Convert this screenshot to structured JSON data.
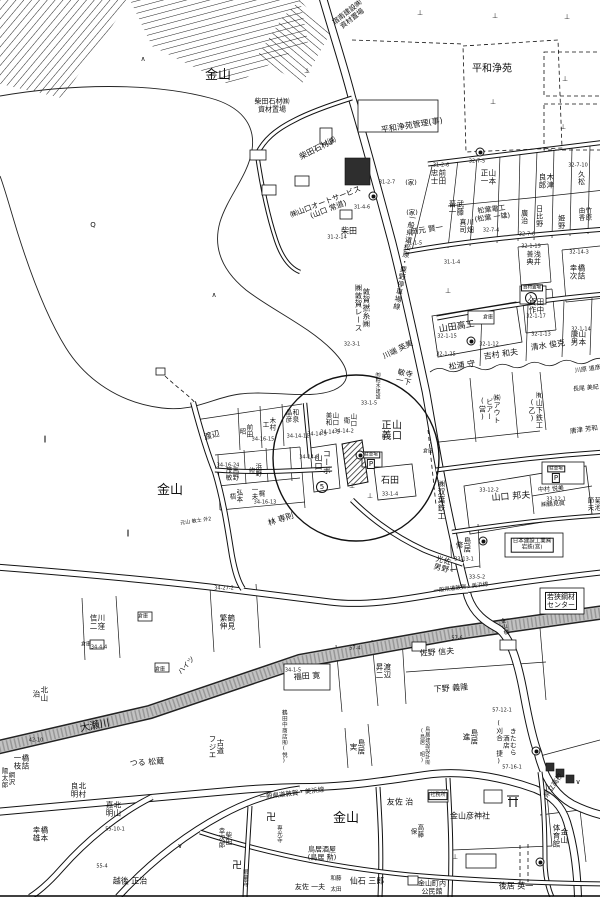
{
  "map": {
    "region_labels": [
      {
        "t": "宿南建設㈱\n資材置場",
        "x": 350,
        "y": 16,
        "s": 7,
        "r": -38
      },
      {
        "t": "金山",
        "x": 218,
        "y": 76,
        "s": 13
      },
      {
        "t": "平和浄苑",
        "x": 492,
        "y": 70,
        "s": 10
      },
      {
        "t": "平和浄苑管理(事)",
        "x": 412,
        "y": 126,
        "s": 8,
        "r": -9
      },
      {
        "t": "柴田石材㈱\n資材置場",
        "x": 272,
        "y": 106,
        "s": 7
      },
      {
        "t": "柴田石材㈱",
        "x": 318,
        "y": 149,
        "s": 8,
        "r": -27
      },
      {
        "t": "㈱山口オートサービス\n(山口 常道)",
        "x": 327,
        "y": 206,
        "s": 7.5,
        "r": -21
      },
      {
        "t": "柴田",
        "x": 349,
        "y": 232,
        "s": 8
      },
      {
        "t": "一般県道松原・粟野停車場線",
        "x": 404,
        "y": 262,
        "s": 7,
        "v": 1,
        "r": 10
      },
      {
        "t": "前田\n忠士",
        "x": 438,
        "y": 177,
        "s": 7.5,
        "v": 1
      },
      {
        "t": "山本\n正一",
        "x": 488,
        "y": 177,
        "s": 7.5,
        "v": 1
      },
      {
        "t": "(家)",
        "x": 411,
        "y": 183,
        "s": 6.5
      },
      {
        "t": "(家)",
        "x": 412,
        "y": 213,
        "s": 6.5
      },
      {
        "t": "武藤\n晋一",
        "x": 456,
        "y": 208,
        "s": 7.5,
        "v": 1
      },
      {
        "t": "岡元 賢一",
        "x": 427,
        "y": 230,
        "s": 7.5,
        "r": -9
      },
      {
        "t": "川畑\n真司",
        "x": 466,
        "y": 226,
        "s": 7,
        "v": 1
      },
      {
        "t": "木津\n良郎",
        "x": 546,
        "y": 181,
        "s": 7.5,
        "v": 1
      },
      {
        "t": "久松",
        "x": 581,
        "y": 178,
        "s": 7,
        "v": 1
      },
      {
        "t": "松葉電工\n(松葉 一雄)",
        "x": 492,
        "y": 214,
        "s": 7,
        "r": -7
      },
      {
        "t": "廣治",
        "x": 524,
        "y": 217,
        "s": 7,
        "v": 1
      },
      {
        "t": "日比野",
        "x": 539,
        "y": 216,
        "s": 7,
        "v": 1
      },
      {
        "t": "姫野",
        "x": 561,
        "y": 222,
        "s": 7,
        "v": 1
      },
      {
        "t": "竹原\n由香",
        "x": 584,
        "y": 214,
        "s": 6.5,
        "v": 1
      },
      {
        "t": "浅井\n善典",
        "x": 533,
        "y": 258,
        "s": 7,
        "v": 1
      },
      {
        "t": "田中\n貞作",
        "x": 536,
        "y": 306,
        "s": 7.5,
        "v": 1
      },
      {
        "t": "橋詰\n幸次",
        "x": 577,
        "y": 272,
        "s": 7.5,
        "v": 1
      },
      {
        "t": "山田高工",
        "x": 457,
        "y": 328,
        "s": 9,
        "r": -9
      },
      {
        "t": "倉庫",
        "x": 488,
        "y": 318,
        "s": 5
      },
      {
        "t": "吉村 和夫",
        "x": 501,
        "y": 355,
        "s": 8,
        "r": -8
      },
      {
        "t": "清水 俊克",
        "x": 548,
        "y": 346,
        "s": 8,
        "r": -8
      },
      {
        "t": "山本\n康男",
        "x": 578,
        "y": 338,
        "s": 7.5,
        "v": 1
      },
      {
        "t": "松浦 守",
        "x": 462,
        "y": 366,
        "s": 8,
        "r": -8
      },
      {
        "t": "川原 道彦",
        "x": 588,
        "y": 370,
        "s": 6,
        "r": -8
      },
      {
        "t": "長尾 美紀",
        "x": 586,
        "y": 389,
        "s": 6,
        "r": -5
      },
      {
        "t": "唐津 芳和",
        "x": 584,
        "y": 430,
        "s": 6.5,
        "r": -7
      },
      {
        "t": "㈱アウト\nビアー\n(営)",
        "x": 489,
        "y": 409,
        "s": 7,
        "v": 1
      },
      {
        "t": "㈲山下鉄工\n(乙)",
        "x": 535,
        "y": 410,
        "s": 7,
        "v": 1
      },
      {
        "t": "山口 邦夫",
        "x": 511,
        "y": 498,
        "s": 9,
        "r": -4
      },
      {
        "t": "中村 悦美",
        "x": 551,
        "y": 490,
        "s": 6,
        "r": -4
      },
      {
        "t": "㈱鶴見眞",
        "x": 553,
        "y": 505,
        "s": 6,
        "r": -4
      },
      {
        "t": "菊池\n節夫",
        "x": 593,
        "y": 504,
        "s": 6.5,
        "v": 1
      },
      {
        "t": "島居\n修",
        "x": 463,
        "y": 545,
        "s": 7.5,
        "v": 1
      },
      {
        "t": "佐野\n光男",
        "x": 442,
        "y": 564,
        "s": 7.5,
        "v": 1,
        "r": 15
      },
      {
        "t": "日本建設工業㈱\n岩鉄(営)",
        "x": 532,
        "y": 545,
        "s": 5.5,
        "box": 1
      },
      {
        "t": "若狭鋼材\nセンター",
        "x": 561,
        "y": 601,
        "s": 7,
        "box": 1
      },
      {
        "t": "一般県道敦賀・美浜線",
        "x": 461,
        "y": 589,
        "s": 5.5,
        "r": -7
      },
      {
        "t": "金山",
        "x": 170,
        "y": 491,
        "s": 13
      },
      {
        "t": "渡辺",
        "x": 212,
        "y": 436,
        "s": 8,
        "r": -14
      },
      {
        "t": "前田\n昭",
        "x": 245,
        "y": 431,
        "s": 6.5,
        "v": 1
      },
      {
        "t": "木村\n工",
        "x": 268,
        "y": 424,
        "s": 6.5,
        "v": 1
      },
      {
        "t": "和泉\n晶彦",
        "x": 291,
        "y": 416,
        "s": 6.5,
        "v": 1
      },
      {
        "t": "山口\n美和",
        "x": 331,
        "y": 419,
        "s": 6.5,
        "v": 1
      },
      {
        "t": "山口\n衛",
        "x": 349,
        "y": 420,
        "s": 6.5,
        "v": 1
      },
      {
        "t": "山口\n正義",
        "x": 389,
        "y": 430,
        "s": 10,
        "v": 1
      },
      {
        "t": "コーポ\n山口",
        "x": 322,
        "y": 462,
        "s": 8,
        "v": 1
      },
      {
        "t": "石田",
        "x": 390,
        "y": 482,
        "s": 9
      },
      {
        "t": "㈱双葉鉄工",
        "x": 441,
        "y": 500,
        "s": 7.5,
        "v": 1
      },
      {
        "t": "倉庫",
        "x": 428,
        "y": 452,
        "s": 5
      },
      {
        "t": "馬野\n茂敏",
        "x": 231,
        "y": 474,
        "s": 6.5,
        "v": 1
      },
      {
        "t": "浜野\n修",
        "x": 254,
        "y": 470,
        "s": 6.5,
        "v": 1
      },
      {
        "t": "梶\n一夫",
        "x": 257,
        "y": 493,
        "s": 6.5,
        "v": 1
      },
      {
        "t": "弘本\n梧",
        "x": 235,
        "y": 496,
        "s": 6.5,
        "v": 1
      },
      {
        "t": "林 専則",
        "x": 281,
        "y": 520,
        "s": 8,
        "r": -18
      },
      {
        "t": "元山 敏士 外2",
        "x": 196,
        "y": 522,
        "s": 5,
        "r": -8
      },
      {
        "t": "寺下\n敏一",
        "x": 404,
        "y": 377,
        "s": 7.5,
        "v": 1,
        "r": 12
      },
      {
        "t": "川端 英美",
        "x": 398,
        "y": 350,
        "s": 7.5,
        "r": -26
      },
      {
        "t": "敦賀撚糸㈱\n㈱敦賀レース",
        "x": 362,
        "y": 308,
        "s": 7.5,
        "v": 1
      },
      {
        "t": "㈲柏木建設",
        "x": 377,
        "y": 386,
        "s": 5,
        "v": 1
      },
      {
        "t": "川窪\n信二",
        "x": 97,
        "y": 622,
        "s": 7.5,
        "v": 1
      },
      {
        "t": "鶴見\n繁伸",
        "x": 227,
        "y": 622,
        "s": 7.5,
        "v": 1
      },
      {
        "t": "北山\n治",
        "x": 40,
        "y": 694,
        "s": 7.5,
        "v": 1
      },
      {
        "t": "大瀬川",
        "x": 95,
        "y": 727,
        "s": 10,
        "r": -11
      },
      {
        "t": "ハイツ",
        "x": 187,
        "y": 666,
        "s": 7,
        "r": -48
      },
      {
        "t": "倉庫",
        "x": 86,
        "y": 645,
        "s": 5
      },
      {
        "t": "倉庫",
        "x": 143,
        "y": 617,
        "s": 5
      },
      {
        "t": "倉庫",
        "x": 160,
        "y": 670,
        "s": 5
      },
      {
        "t": "福田 寛",
        "x": 307,
        "y": 677,
        "s": 8,
        "r": -4
      },
      {
        "t": "渡辺\n昇二",
        "x": 383,
        "y": 671,
        "s": 7.5,
        "v": 1
      },
      {
        "t": "佐野 信夫",
        "x": 437,
        "y": 653,
        "s": 8,
        "r": -4
      },
      {
        "t": "下野 義隆",
        "x": 451,
        "y": 689,
        "s": 8,
        "r": -4
      },
      {
        "t": "島居\n実",
        "x": 357,
        "y": 747,
        "s": 7.5,
        "v": 1
      },
      {
        "t": "島居\n進",
        "x": 470,
        "y": 737,
        "s": 7.5,
        "v": 1
      },
      {
        "t": "きたむら\n酒店\n(刈合 捷)",
        "x": 505,
        "y": 742,
        "s": 6.5,
        "v": 1
      },
      {
        "t": "鳥居建設設計㈲\n(鳥居 昭)",
        "x": 424,
        "y": 746,
        "s": 5,
        "v": 1
      },
      {
        "t": "鶴田中商店㈲(悦)",
        "x": 283,
        "y": 737,
        "s": 5.5,
        "v": 1
      },
      {
        "t": "金山橋",
        "x": 503,
        "y": 627,
        "s": 5.5,
        "v": 1,
        "r": -15
      },
      {
        "t": "県立高校",
        "x": 554,
        "y": 786,
        "s": 7,
        "r": -55
      },
      {
        "t": "橋詰\n一枝",
        "x": 21,
        "y": 762,
        "s": 7.5,
        "v": 1
      },
      {
        "t": "網沢\n陽太郎",
        "x": 7,
        "y": 778,
        "s": 6.5,
        "v": 1
      },
      {
        "t": "北村\n良明",
        "x": 78,
        "y": 790,
        "s": 7.5,
        "v": 1
      },
      {
        "t": "北山\n嘉明",
        "x": 113,
        "y": 809,
        "s": 7.5,
        "v": 1
      },
      {
        "t": "橋本\n幸雄",
        "x": 40,
        "y": 834,
        "s": 7.5,
        "v": 1
      },
      {
        "t": "つる 松蔵",
        "x": 147,
        "y": 763,
        "s": 8,
        "r": -4
      },
      {
        "t": "古道\nフジエ",
        "x": 216,
        "y": 747,
        "s": 7.5,
        "v": 1
      },
      {
        "t": "一般県道敦賀・美浜線",
        "x": 292,
        "y": 794,
        "s": 6.5,
        "r": -7
      },
      {
        "t": "越後 正治",
        "x": 130,
        "y": 882,
        "s": 8
      },
      {
        "t": "柴田\n幸次郎",
        "x": 224,
        "y": 838,
        "s": 6.5,
        "v": 1
      },
      {
        "t": "専光寺",
        "x": 278,
        "y": 834,
        "s": 5.5,
        "v": 1
      },
      {
        "t": "眼量寺",
        "x": 244,
        "y": 878,
        "s": 5.5,
        "v": 1
      },
      {
        "t": "金山",
        "x": 346,
        "y": 819,
        "s": 13
      },
      {
        "t": "友佐 治",
        "x": 400,
        "y": 803,
        "s": 8
      },
      {
        "t": "高藤\n保",
        "x": 416,
        "y": 831,
        "s": 6.5,
        "v": 1
      },
      {
        "t": "社務所",
        "x": 438,
        "y": 796,
        "s": 5,
        "box": 1
      },
      {
        "t": "金山彦神社",
        "x": 470,
        "y": 817,
        "s": 8
      },
      {
        "t": "金山\n体育館",
        "x": 560,
        "y": 836,
        "s": 7.5,
        "v": 1
      },
      {
        "t": "鳥居酒屋\n(鳥居 勲)",
        "x": 322,
        "y": 854,
        "s": 7
      },
      {
        "t": "友佐 一夫",
        "x": 310,
        "y": 888,
        "s": 7
      },
      {
        "t": "和藤",
        "x": 336,
        "y": 880,
        "s": 5.5
      },
      {
        "t": "太田",
        "x": 336,
        "y": 891,
        "s": 5.5
      },
      {
        "t": "仙石 三郎",
        "x": 367,
        "y": 882,
        "s": 8
      },
      {
        "t": "金山町内\n公民館",
        "x": 432,
        "y": 888,
        "s": 7
      },
      {
        "t": "後居 英一",
        "x": 516,
        "y": 887,
        "s": 8
      },
      {
        "t": "駐車場",
        "x": 556,
        "y": 469,
        "s": 4.5,
        "box": 1
      },
      {
        "t": "駐車場",
        "x": 371,
        "y": 455,
        "s": 4.5,
        "box": 1
      },
      {
        "t": "資材置場",
        "x": 532,
        "y": 288,
        "s": 4.5,
        "box": 1
      }
    ],
    "parcel_numbers": [
      {
        "t": "31-2-7",
        "x": 387,
        "y": 183
      },
      {
        "t": "31-4-6",
        "x": 362,
        "y": 208
      },
      {
        "t": "31-2-14",
        "x": 337,
        "y": 238
      },
      {
        "t": "31-2-6",
        "x": 441,
        "y": 166
      },
      {
        "t": "32-7-5",
        "x": 477,
        "y": 162
      },
      {
        "t": "32-7-10",
        "x": 578,
        "y": 166
      },
      {
        "t": "32-7-4",
        "x": 491,
        "y": 231
      },
      {
        "t": "32-7-6",
        "x": 527,
        "y": 235
      },
      {
        "t": "31-1-5",
        "x": 414,
        "y": 244
      },
      {
        "t": "31-1-4",
        "x": 452,
        "y": 263
      },
      {
        "t": "32-1-19",
        "x": 531,
        "y": 247
      },
      {
        "t": "32-14-3",
        "x": 579,
        "y": 253
      },
      {
        "t": "32-1-17",
        "x": 536,
        "y": 317
      },
      {
        "t": "32-1-15",
        "x": 447,
        "y": 337
      },
      {
        "t": "32-1-12",
        "x": 489,
        "y": 345
      },
      {
        "t": "32-1-13",
        "x": 541,
        "y": 335
      },
      {
        "t": "32-1-14",
        "x": 581,
        "y": 330
      },
      {
        "t": "32-1-25",
        "x": 446,
        "y": 355
      },
      {
        "t": "32-3-1",
        "x": 352,
        "y": 345
      },
      {
        "t": "34-16-15",
        "x": 263,
        "y": 440
      },
      {
        "t": "34-16-24",
        "x": 228,
        "y": 466
      },
      {
        "t": "34-16-13",
        "x": 265,
        "y": 503
      },
      {
        "t": "34-14-11",
        "x": 298,
        "y": 437
      },
      {
        "t": "34-14-9",
        "x": 317,
        "y": 435
      },
      {
        "t": "34-14-5",
        "x": 330,
        "y": 433
      },
      {
        "t": "34-14-2",
        "x": 344,
        "y": 432
      },
      {
        "t": "34-14-8",
        "x": 309,
        "y": 458
      },
      {
        "t": "33-1-5",
        "x": 369,
        "y": 404
      },
      {
        "t": "33-1-4",
        "x": 390,
        "y": 495
      },
      {
        "t": "33-12-2",
        "x": 489,
        "y": 491
      },
      {
        "t": "33-12-1",
        "x": 556,
        "y": 500
      },
      {
        "t": "33-13-1",
        "x": 464,
        "y": 560
      },
      {
        "t": "33-5-2",
        "x": 477,
        "y": 578
      },
      {
        "t": "57-6",
        "x": 457,
        "y": 639
      },
      {
        "t": "57-4",
        "x": 355,
        "y": 649
      },
      {
        "t": "57-12-1",
        "x": 502,
        "y": 711
      },
      {
        "t": "57-16-1",
        "x": 512,
        "y": 768
      },
      {
        "t": "34-1-5",
        "x": 293,
        "y": 671
      },
      {
        "t": "34-27-2",
        "x": 224,
        "y": 589
      },
      {
        "t": "34-4-4",
        "x": 99,
        "y": 648
      },
      {
        "t": "42-10",
        "x": 36,
        "y": 741
      },
      {
        "t": "55-10-1",
        "x": 115,
        "y": 830
      },
      {
        "t": "55-4",
        "x": 102,
        "y": 867
      }
    ],
    "symbols": [
      {
        "g": "⊥",
        "x": 420,
        "y": 14
      },
      {
        "g": "⊥",
        "x": 495,
        "y": 17
      },
      {
        "g": "⊥",
        "x": 567,
        "y": 18
      },
      {
        "g": "⊥",
        "x": 307,
        "y": 72
      },
      {
        "g": "⊥",
        "x": 565,
        "y": 80
      },
      {
        "g": "⊥",
        "x": 493,
        "y": 103
      },
      {
        "g": "⊥",
        "x": 563,
        "y": 128
      },
      {
        "g": "⊥",
        "x": 448,
        "y": 292
      },
      {
        "g": "⊥",
        "x": 352,
        "y": 487
      },
      {
        "g": "⊥",
        "x": 370,
        "y": 497
      },
      {
        "g": "⊥",
        "x": 455,
        "y": 858
      },
      {
        "g": "∧",
        "x": 143,
        "y": 60
      },
      {
        "g": "∧",
        "x": 214,
        "y": 296
      },
      {
        "g": "∨",
        "x": 180,
        "y": 847
      },
      {
        "g": "∨",
        "x": 578,
        "y": 783
      },
      {
        "g": "Q",
        "x": 93,
        "y": 226
      },
      {
        "g": "∥",
        "x": 45,
        "y": 440
      },
      {
        "g": "∥",
        "x": 128,
        "y": 534
      },
      {
        "g": "卍",
        "x": 271,
        "y": 819,
        "s": 10
      },
      {
        "g": "卍",
        "x": 237,
        "y": 867,
        "s": 10
      },
      {
        "g": "P",
        "x": 371,
        "y": 464,
        "kind": "box"
      },
      {
        "g": "P",
        "x": 556,
        "y": 478,
        "kind": "box"
      },
      {
        "g": "入",
        "x": 531,
        "y": 298,
        "kind": "circ"
      },
      {
        "g": "5",
        "x": 322,
        "y": 487,
        "kind": "circ"
      }
    ],
    "route_markers": [
      [
        373,
        196
      ],
      [
        480,
        152
      ],
      [
        471,
        341
      ],
      [
        483,
        541
      ],
      [
        536,
        751
      ],
      [
        360,
        455
      ],
      [
        540,
        862
      ]
    ]
  }
}
